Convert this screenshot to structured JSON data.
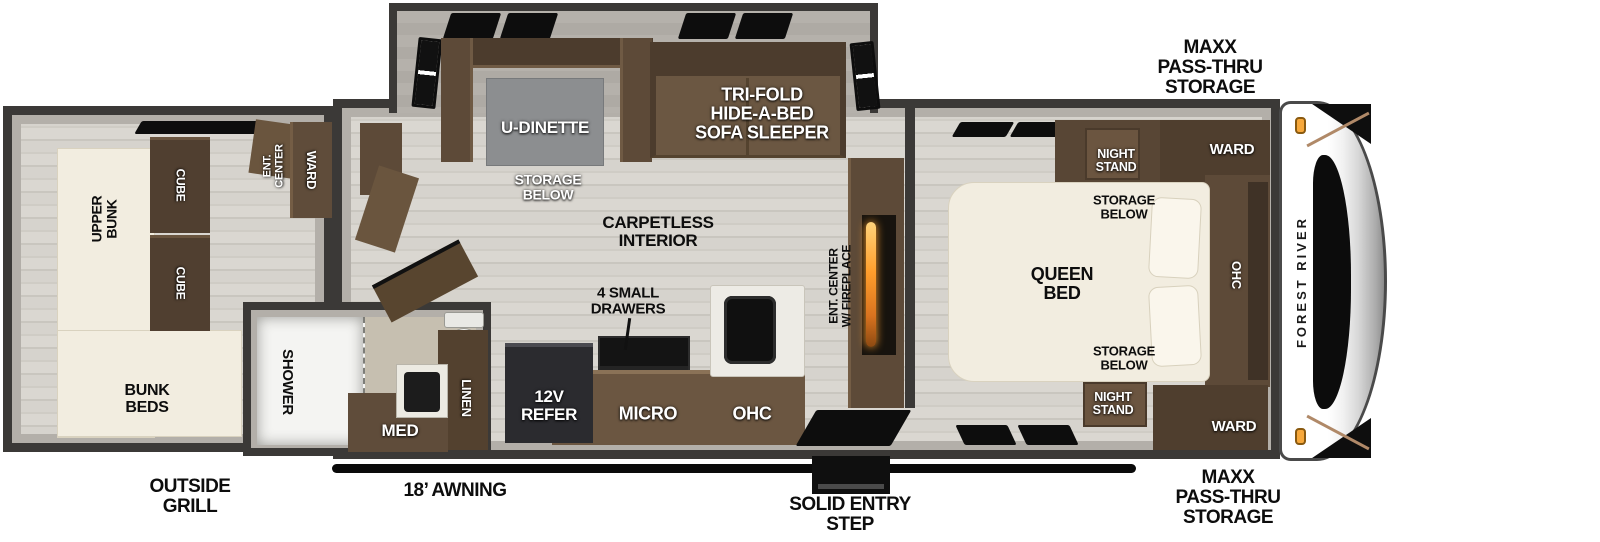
{
  "brand": {
    "name": "FOREST RIVER"
  },
  "exterior": {
    "storage_front_top": "MAXX\nPASS-THRU\nSTORAGE",
    "storage_front_bottom": "MAXX\nPASS-THRU\nSTORAGE",
    "outside_grill": "OUTSIDE\nGRILL",
    "awning": "18’ AWNING",
    "entry_step": "SOLID ENTRY\nSTEP"
  },
  "bunk_room": {
    "upper_bunk": "UPPER\nBUNK",
    "bunk_beds": "BUNK\nBEDS",
    "cube_1": "CUBE",
    "cube_2": "CUBE",
    "ent_center": "ENT.\nCENTER",
    "wardrobe": "WARD"
  },
  "bathroom": {
    "shower": "SHOWER",
    "medicine_cabinet": "MED",
    "linen": "LINEN"
  },
  "living_area": {
    "dinette": "U-DINETTE",
    "dinette_storage": "STORAGE\nBELOW",
    "sofa": "TRI-FOLD\nHIDE-A-BED\nSOFA SLEEPER",
    "interior_note": "CARPETLESS\nINTERIOR",
    "drawers": "4 SMALL\nDRAWERS",
    "ent_center_fireplace": "ENT. CENTER\nW/ FIREPLACE"
  },
  "kitchen": {
    "refrigerator": "12V\nREFER",
    "microwave": "MICRO",
    "overhead_cabinet": "OHC"
  },
  "bedroom": {
    "bed": "QUEEN\nBED",
    "night_stand_top": "NIGHT\nSTAND",
    "night_stand_bottom": "NIGHT\nSTAND",
    "storage_below_top": "STORAGE\nBELOW",
    "storage_below_bottom": "STORAGE\nBELOW",
    "wardrobe_top": "WARD",
    "wardrobe_bottom": "WARD",
    "overhead_cabinet": "OHC"
  },
  "colors": {
    "wall_outline": "#3b3937",
    "furniture_brown": "#5d4a38",
    "bed_cream": "#f2ede0",
    "fireplace_flame": "#ff9e2c",
    "marker_light": "#f7a83b"
  }
}
